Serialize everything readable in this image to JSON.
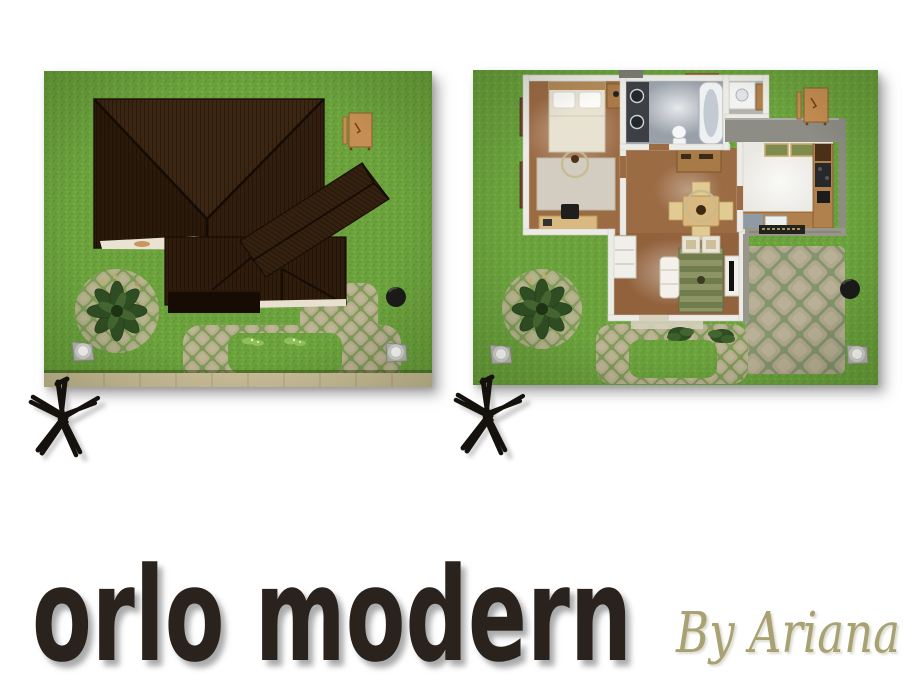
{
  "title": {
    "text": "orlo modern"
  },
  "author": {
    "text": "By Ariana"
  },
  "marks": {
    "symbol": "asterisk"
  },
  "panels": {
    "left": {
      "name": "exterior-roof-aerial-view",
      "elements": [
        "grass-lawn",
        "hip-roof",
        "porch-awning",
        "picnic-bench",
        "palm-shrub",
        "cobblestone-path",
        "globe-lamp",
        "globe-lamp",
        "trash-can",
        "sidewalk"
      ]
    },
    "right": {
      "name": "interior-floorplan-aerial-view",
      "elements": [
        "grass-lawn",
        "bedroom",
        "double-bed",
        "area-rug",
        "desk",
        "bathroom",
        "bathtub",
        "toilet",
        "sink-counter",
        "washer",
        "kitchen",
        "counters",
        "stove",
        "dining-table",
        "chairs",
        "armoire",
        "living-room",
        "sofa",
        "striped-rug",
        "tv-stand",
        "armchairs",
        "patio-cobbles",
        "stone-wall",
        "garden-bench",
        "palm-shrub",
        "globe-lamp",
        "globe-lamp",
        "trash-can",
        "entry-shrubs"
      ]
    }
  },
  "colors": {
    "page_bg": "#ffffff",
    "title_text": "#2a241c",
    "author_text": "#a8a273",
    "grass": "#6ba23d",
    "roof": "#33200f",
    "cobble": "#b7ae8d",
    "sidewalk": "#cdc09a",
    "wood_floor": "#9b6b44",
    "tile_gray": "#99a0a9",
    "tile_white": "#e9e8e2",
    "wall_white": "#ecebe5",
    "rug_green": "#8d9465",
    "mark_black": "#15120e"
  }
}
